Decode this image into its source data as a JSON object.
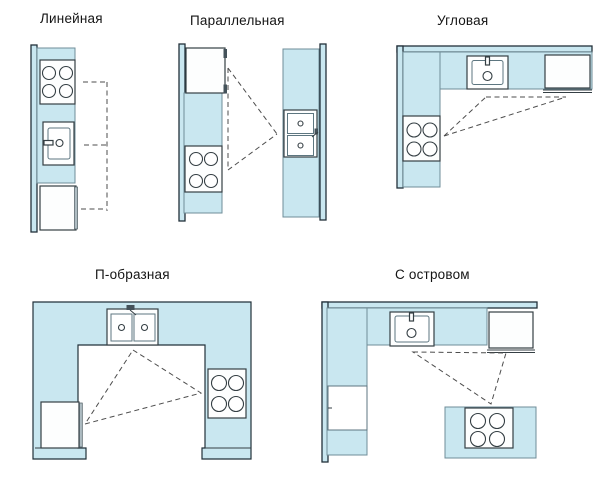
{
  "figure": {
    "background": "#ffffff"
  },
  "colors": {
    "counter": "#c9e7f0",
    "counterBorder": "#6f8d98",
    "wallBorder": "#22313a",
    "appliance": "#fdfefe",
    "applianceBorder": "#353f44",
    "innerBorder": "#5d7680",
    "dash": "#4d4d4d",
    "handle": "#aebcc2",
    "title": "#141414"
  },
  "diagrams": [
    {
      "id": "linear",
      "title": "Линейная",
      "icons": [
        "wall",
        "counter",
        "stove-icon",
        "sink-icon",
        "refrigerator-icon",
        "work-path-dashed"
      ]
    },
    {
      "id": "parallel",
      "title": "Параллельная",
      "icons": [
        "wall",
        "counter",
        "refrigerator-icon",
        "stove-icon",
        "double-sink-icon",
        "work-triangle-dashed"
      ]
    },
    {
      "id": "corner",
      "title": "Угловая",
      "icons": [
        "wall",
        "counter",
        "sink-icon",
        "refrigerator-icon",
        "stove-icon",
        "work-triangle-dashed"
      ]
    },
    {
      "id": "u-shaped",
      "title": "П-образная",
      "icons": [
        "counter",
        "double-sink-icon",
        "stove-icon",
        "refrigerator-icon",
        "work-triangle-dashed"
      ]
    },
    {
      "id": "island",
      "title": "С островом",
      "icons": [
        "wall",
        "counter",
        "sink-icon",
        "refrigerator-icon",
        "cabinet-icon",
        "island-counter",
        "stove-icon",
        "work-triangle-dashed"
      ]
    }
  ]
}
